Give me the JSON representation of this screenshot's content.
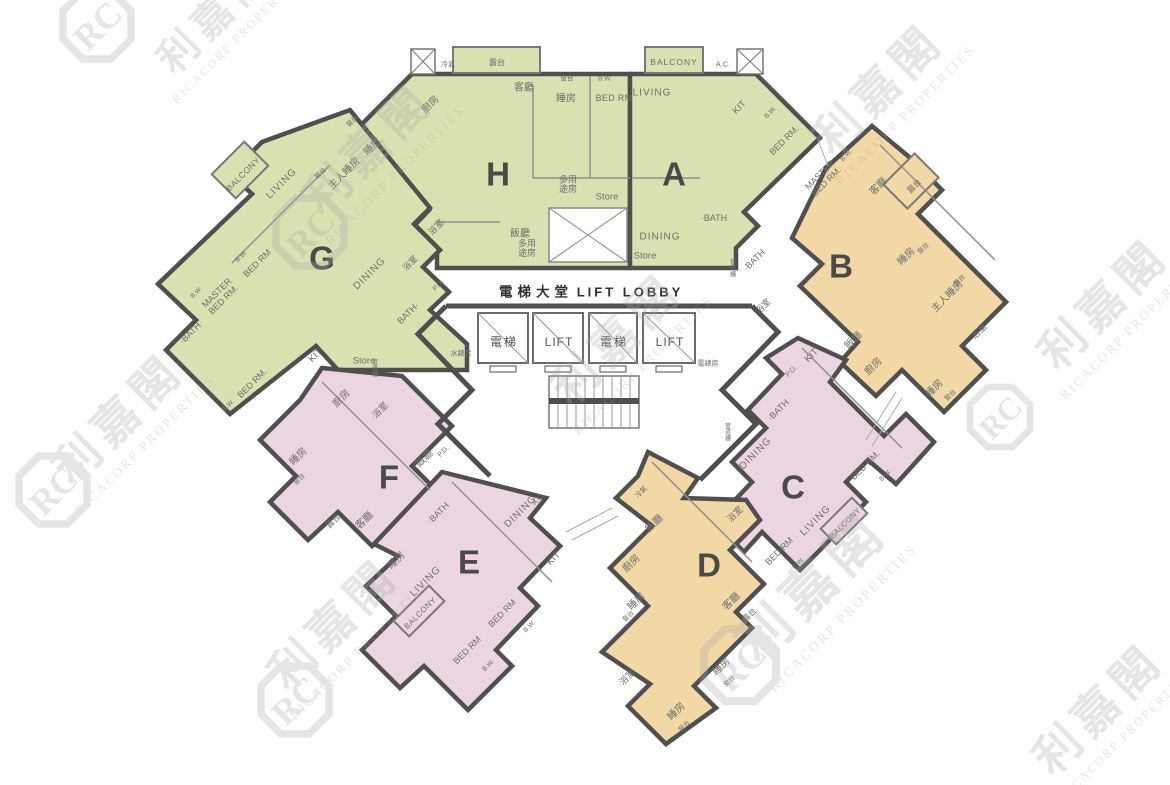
{
  "plan_title": "Residential floor plan with units A-H around central lift lobby",
  "palette": {
    "green": "#d9e1b0",
    "orange": "#f1d8a5",
    "pink": "#ecd5e2",
    "wall": "#4f4f4f",
    "thin": "#8f8f8f",
    "label": "#6e6e6e",
    "letter": "#4a4a4a",
    "lobby_text": "#2f2f2f",
    "watermark": "#a9a9a9"
  },
  "units": [
    {
      "id": "H",
      "color_key": "green"
    },
    {
      "id": "A",
      "color_key": "green"
    },
    {
      "id": "G",
      "color_key": "green"
    },
    {
      "id": "B",
      "color_key": "orange"
    },
    {
      "id": "F",
      "color_key": "pink"
    },
    {
      "id": "E",
      "color_key": "pink"
    },
    {
      "id": "C",
      "color_key": "pink"
    },
    {
      "id": "D",
      "color_key": "orange"
    }
  ],
  "watermark": {
    "cn": "利嘉閣",
    "en": "RICACORP PROPERTIES",
    "logo": "RC",
    "instances": [
      {
        "x": 890,
        "y": 100,
        "cs": 46,
        "es": 13
      },
      {
        "x": 380,
        "y": 160,
        "cs": 46,
        "es": 13
      },
      {
        "x": 628,
        "y": 350,
        "cs": 46,
        "es": 13
      },
      {
        "x": 1115,
        "y": 315,
        "cs": 46,
        "es": 13
      },
      {
        "x": 130,
        "y": 430,
        "cs": 46,
        "es": 13
      },
      {
        "x": 345,
        "y": 635,
        "cs": 46,
        "es": 13
      },
      {
        "x": 825,
        "y": 600,
        "cs": 54,
        "es": 14
      },
      {
        "x": 1110,
        "y": 720,
        "cs": 46,
        "es": 12
      },
      {
        "x": 225,
        "y": 25,
        "cs": 40,
        "es": 12
      }
    ],
    "logos": [
      {
        "x": 97,
        "y": 25,
        "s": 34
      },
      {
        "x": 310,
        "y": 232,
        "s": 34
      },
      {
        "x": 53,
        "y": 490,
        "s": 34
      },
      {
        "x": 295,
        "y": 700,
        "s": 34
      },
      {
        "x": 740,
        "y": 665,
        "s": 36
      },
      {
        "x": 1000,
        "y": 417,
        "s": 30
      }
    ]
  },
  "labels": [
    {
      "t": "電梯大堂",
      "x": 536,
      "y": 292,
      "s": 13.5,
      "ls": 5,
      "b": 1,
      "c": "#2f2f2f"
    },
    {
      "t": "LIFT LOBBY",
      "x": 630,
      "y": 292,
      "s": 13,
      "ls": 3,
      "b": 1,
      "c": "#2f2f2f"
    },
    {
      "t": "電梯",
      "x": 504,
      "y": 342,
      "s": 12,
      "ls": 2,
      "c": "#555555"
    },
    {
      "t": "LIFT",
      "x": 559,
      "y": 342,
      "s": 12,
      "ls": 1,
      "c": "#555555"
    },
    {
      "t": "電梯",
      "x": 614,
      "y": 342,
      "s": 12,
      "ls": 2,
      "c": "#555555"
    },
    {
      "t": "LIFT",
      "x": 670,
      "y": 342,
      "s": 12,
      "ls": 1,
      "c": "#555555"
    },
    {
      "t": "水錶房",
      "x": 461,
      "y": 353,
      "s": 7
    },
    {
      "t": "電錶房",
      "x": 708,
      "y": 363,
      "s": 7
    },
    {
      "t": "H",
      "x": 498,
      "y": 174,
      "s": 33,
      "b": 1,
      "c": "#4a4a4a"
    },
    {
      "t": "A",
      "x": 674,
      "y": 174,
      "s": 33,
      "b": 1,
      "c": "#4a4a4a"
    },
    {
      "t": "G",
      "x": 322,
      "y": 258,
      "s": 33,
      "b": 1,
      "c": "#4a4a4a"
    },
    {
      "t": "B",
      "x": 841,
      "y": 266,
      "s": 33,
      "b": 1,
      "c": "#4a4a4a"
    },
    {
      "t": "F",
      "x": 389,
      "y": 477,
      "s": 33,
      "b": 1,
      "c": "#4a4a4a"
    },
    {
      "t": "E",
      "x": 469,
      "y": 562,
      "s": 33,
      "b": 1,
      "c": "#4a4a4a"
    },
    {
      "t": "C",
      "x": 793,
      "y": 487,
      "s": 33,
      "b": 1,
      "c": "#4a4a4a"
    },
    {
      "t": "D",
      "x": 709,
      "y": 565,
      "s": 33,
      "b": 1,
      "c": "#4a4a4a"
    },
    {
      "t": "冷氣",
      "x": 448,
      "y": 64,
      "s": 7
    },
    {
      "t": "露台",
      "x": 497,
      "y": 62,
      "s": 8
    },
    {
      "t": "客廳",
      "x": 524,
      "y": 87,
      "s": 10
    },
    {
      "t": "廚房",
      "x": 430,
      "y": 104,
      "r": -45,
      "s": 10
    },
    {
      "t": "睡房",
      "x": 566,
      "y": 98,
      "s": 10
    },
    {
      "t": "窗台",
      "x": 567,
      "y": 78,
      "s": 6.5
    },
    {
      "t": "B.W.",
      "x": 605,
      "y": 78,
      "s": 6.5
    },
    {
      "t": "BED RM",
      "x": 614,
      "y": 98,
      "s": 9,
      "ls": 0.3
    },
    {
      "t": "浴室·",
      "x": 437,
      "y": 226,
      "r": -45,
      "s": 9
    },
    {
      "t": "多用\n途房",
      "x": 568,
      "y": 184,
      "s": 9
    },
    {
      "t": "Store",
      "x": 607,
      "y": 196,
      "s": 9.5
    },
    {
      "t": "飯廳",
      "x": 520,
      "y": 233,
      "s": 10
    },
    {
      "t": "多用\n途房",
      "x": 527,
      "y": 248,
      "s": 9
    },
    {
      "t": "BALCONY",
      "x": 674,
      "y": 62,
      "s": 8.5,
      "ls": 1
    },
    {
      "t": "A.C.",
      "x": 723,
      "y": 64,
      "s": 7.5
    },
    {
      "t": "LIVING",
      "x": 652,
      "y": 92,
      "s": 10,
      "ls": 1
    },
    {
      "t": "KIT",
      "x": 739,
      "y": 107,
      "r": -45,
      "s": 9.5
    },
    {
      "t": "B.W.",
      "x": 770,
      "y": 112,
      "r": -45,
      "s": 6.5
    },
    {
      "t": "BED RM.",
      "x": 784,
      "y": 140,
      "r": -45,
      "s": 9
    },
    {
      "t": "B.W.",
      "x": 846,
      "y": 155,
      "r": -45,
      "s": 6.5
    },
    {
      "t": "MASTER\nBED RM.",
      "x": 823,
      "y": 178,
      "r": -45,
      "s": 9
    },
    {
      "t": "·BATH",
      "x": 714,
      "y": 218,
      "s": 9
    },
    {
      "t": "·BATH",
      "x": 754,
      "y": 260,
      "r": -45,
      "s": 9
    },
    {
      "t": "DINING",
      "x": 660,
      "y": 236,
      "s": 10,
      "ls": 1
    },
    {
      "t": "Store",
      "x": 645,
      "y": 255,
      "s": 9.5
    },
    {
      "t": "BALCONY",
      "x": 243,
      "y": 174,
      "r": -45,
      "s": 8.5,
      "ls": 0.5
    },
    {
      "t": "LIVING",
      "x": 281,
      "y": 183,
      "r": -45,
      "s": 10,
      "ls": 1
    },
    {
      "t": "睡房",
      "x": 372,
      "y": 146,
      "r": -45,
      "s": 10
    },
    {
      "t": "窗台",
      "x": 352,
      "y": 121,
      "r": -45,
      "s": 6.5
    },
    {
      "t": "主人睡房",
      "x": 344,
      "y": 173,
      "r": -45,
      "s": 10
    },
    {
      "t": "窗台",
      "x": 320,
      "y": 173,
      "r": -45,
      "s": 6.5
    },
    {
      "t": "B.W.",
      "x": 241,
      "y": 256,
      "r": -45,
      "s": 6.5
    },
    {
      "t": "BED RM",
      "x": 257,
      "y": 263,
      "r": -45,
      "s": 9
    },
    {
      "t": "MASTER\nBED RM.",
      "x": 220,
      "y": 296,
      "r": -45,
      "s": 9
    },
    {
      "t": "B.W.",
      "x": 196,
      "y": 292,
      "r": -45,
      "s": 6.5
    },
    {
      "t": "·BATH",
      "x": 190,
      "y": 333,
      "r": -45,
      "s": 9
    },
    {
      "t": "BED RM.",
      "x": 252,
      "y": 383,
      "r": -45,
      "s": 9
    },
    {
      "t": "B.W.",
      "x": 228,
      "y": 405,
      "r": -45,
      "s": 6.5
    },
    {
      "t": "DINING",
      "x": 369,
      "y": 273,
      "r": -45,
      "s": 10,
      "ls": 1
    },
    {
      "t": "浴室",
      "x": 410,
      "y": 263,
      "r": -45,
      "s": 8.5
    },
    {
      "t": "BATH·",
      "x": 408,
      "y": 313,
      "r": -45,
      "s": 9
    },
    {
      "t": "KIT",
      "x": 315,
      "y": 355,
      "r": -45,
      "s": 9.5
    },
    {
      "t": "Store",
      "x": 364,
      "y": 360,
      "s": 9.5
    },
    {
      "t": "P.D.",
      "x": 438,
      "y": 285,
      "r": -45,
      "s": 7
    },
    {
      "t": "客廳",
      "x": 878,
      "y": 186,
      "r": -45,
      "s": 10
    },
    {
      "t": "露台",
      "x": 914,
      "y": 186,
      "r": -45,
      "s": 8
    },
    {
      "t": "睡房",
      "x": 906,
      "y": 256,
      "r": -45,
      "s": 10
    },
    {
      "t": "窗台",
      "x": 923,
      "y": 248,
      "r": -45,
      "s": 6.5
    },
    {
      "t": "主人睡房",
      "x": 947,
      "y": 296,
      "r": -45,
      "s": 10
    },
    {
      "t": "露台",
      "x": 959,
      "y": 280,
      "r": -45,
      "s": 6.5
    },
    {
      "t": "浴室·",
      "x": 980,
      "y": 330,
      "r": -45,
      "s": 9
    },
    {
      "t": "飯廳",
      "x": 853,
      "y": 340,
      "r": -45,
      "s": 10
    },
    {
      "t": "廚房",
      "x": 873,
      "y": 366,
      "r": -45,
      "s": 10
    },
    {
      "t": "睡房",
      "x": 934,
      "y": 388,
      "r": -45,
      "s": 10
    },
    {
      "t": "窗台",
      "x": 950,
      "y": 395,
      "r": -45,
      "s": 6.5
    },
    {
      "t": "浴室",
      "x": 763,
      "y": 306,
      "r": -45,
      "s": 8.5
    },
    {
      "t": "管\n道\n槽",
      "x": 733,
      "y": 268,
      "s": 6
    },
    {
      "t": "廚房",
      "x": 341,
      "y": 398,
      "r": -45,
      "s": 10
    },
    {
      "t": "·浴室",
      "x": 379,
      "y": 411,
      "r": -45,
      "s": 9
    },
    {
      "t": "睡房",
      "x": 298,
      "y": 456,
      "r": -45,
      "s": 10
    },
    {
      "t": "窗台",
      "x": 299,
      "y": 479,
      "r": -45,
      "s": 6.5
    },
    {
      "t": "露台",
      "x": 333,
      "y": 521,
      "r": -45,
      "s": 8
    },
    {
      "t": "客廳",
      "x": 364,
      "y": 520,
      "r": -45,
      "s": 10
    },
    {
      "t": "飯廳",
      "x": 424,
      "y": 458,
      "r": -45,
      "s": 10
    },
    {
      "t": "P.D.",
      "x": 443,
      "y": 451,
      "r": -45,
      "s": 7
    },
    {
      "t": "管\n道\n槽",
      "x": 375,
      "y": 368,
      "s": 6
    },
    {
      "t": "·BATH",
      "x": 438,
      "y": 513,
      "r": -45,
      "s": 9
    },
    {
      "t": "DINING",
      "x": 520,
      "y": 511,
      "r": -45,
      "s": 10,
      "ls": 1
    },
    {
      "t": "A.C.",
      "x": 538,
      "y": 499,
      "r": -45,
      "s": 7
    },
    {
      "t": "KIT",
      "x": 553,
      "y": 558,
      "r": -45,
      "s": 9.5
    },
    {
      "t": "睡房",
      "x": 396,
      "y": 560,
      "r": -45,
      "s": 10
    },
    {
      "t": "LIVING",
      "x": 425,
      "y": 581,
      "r": -45,
      "s": 10,
      "ls": 1
    },
    {
      "t": "BALCONY",
      "x": 420,
      "y": 613,
      "r": -45,
      "s": 8,
      "ls": 0.5
    },
    {
      "t": "BED RM",
      "x": 502,
      "y": 613,
      "r": -45,
      "s": 9
    },
    {
      "t": "B.W.",
      "x": 529,
      "y": 626,
      "r": -45,
      "s": 6.5
    },
    {
      "t": "BED RM",
      "x": 467,
      "y": 650,
      "r": -45,
      "s": 9
    },
    {
      "t": "B.W.",
      "x": 488,
      "y": 665,
      "r": -45,
      "s": 6.5
    },
    {
      "t": "KIT",
      "x": 811,
      "y": 355,
      "r": -45,
      "s": 9.5
    },
    {
      "t": "P.D.",
      "x": 791,
      "y": 371,
      "r": -45,
      "s": 7
    },
    {
      "t": "·BATH",
      "x": 778,
      "y": 410,
      "r": -45,
      "s": 9
    },
    {
      "t": "DINING",
      "x": 755,
      "y": 453,
      "r": -45,
      "s": 10,
      "ls": 1
    },
    {
      "t": "BED RM.",
      "x": 865,
      "y": 465,
      "r": -45,
      "s": 9
    },
    {
      "t": "B.W.",
      "x": 885,
      "y": 475,
      "r": -45,
      "s": 6.5
    },
    {
      "t": "LIVING",
      "x": 815,
      "y": 520,
      "r": -45,
      "s": 10,
      "ls": 1
    },
    {
      "t": "BALCONY",
      "x": 845,
      "y": 523,
      "r": -45,
      "s": 8,
      "ls": 0.3
    },
    {
      "t": "BED RM",
      "x": 779,
      "y": 551,
      "r": -45,
      "s": 9
    },
    {
      "t": "B.W.",
      "x": 798,
      "y": 563,
      "r": -45,
      "s": 6.5
    },
    {
      "t": "管\n道\n槽",
      "x": 728,
      "y": 432,
      "s": 6
    },
    {
      "t": "冷氣",
      "x": 641,
      "y": 492,
      "r": -45,
      "s": 7
    },
    {
      "t": "飯廳",
      "x": 654,
      "y": 523,
      "r": -45,
      "s": 10
    },
    {
      "t": "廚房",
      "x": 631,
      "y": 563,
      "r": -45,
      "s": 10
    },
    {
      "t": "浴室·",
      "x": 736,
      "y": 513,
      "r": -45,
      "s": 9
    },
    {
      "t": "睡房",
      "x": 636,
      "y": 601,
      "r": -45,
      "s": 10
    },
    {
      "t": "窗台",
      "x": 628,
      "y": 616,
      "r": -45,
      "s": 6.5
    },
    {
      "t": "客廳",
      "x": 731,
      "y": 601,
      "r": -45,
      "s": 10
    },
    {
      "t": "露台",
      "x": 749,
      "y": 615,
      "r": -45,
      "s": 8
    },
    {
      "t": "睡房",
      "x": 721,
      "y": 666,
      "r": -45,
      "s": 10
    },
    {
      "t": "窗台",
      "x": 729,
      "y": 681,
      "r": -45,
      "s": 6.5
    },
    {
      "t": "·浴室",
      "x": 626,
      "y": 678,
      "r": -45,
      "s": 9
    },
    {
      "t": "睡房",
      "x": 676,
      "y": 711,
      "r": -45,
      "s": 10
    },
    {
      "t": "窗台",
      "x": 684,
      "y": 726,
      "r": -45,
      "s": 6.5
    }
  ]
}
